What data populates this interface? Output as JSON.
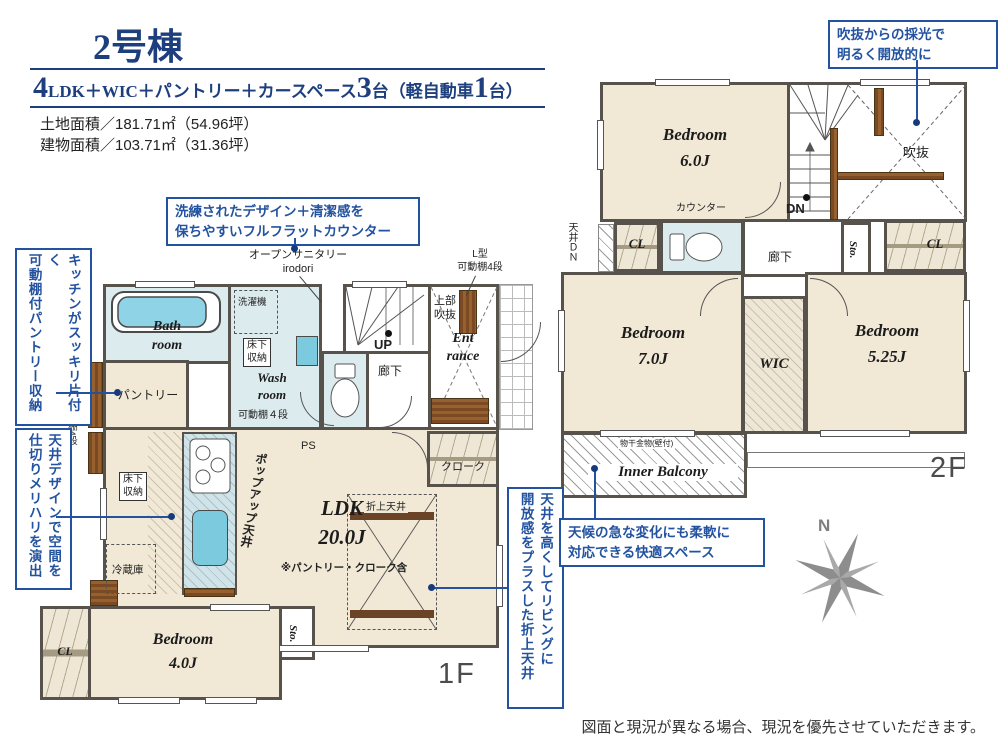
{
  "hdr": {
    "building": "2号棟",
    "spec": {
      "n1": "4",
      "t1": "LDK＋WIC＋パントリー＋カースペース",
      "n2": "3",
      "t2": "台（軽自動車",
      "n3": "1",
      "t3": "台）"
    },
    "land_area": "土地面積／181.71㎡（54.96坪）",
    "building_area": "建物面積／103.71㎡（31.36坪）"
  },
  "co": {
    "void_light": "吹抜からの採光で\n明るく開放的に",
    "flat_counter": "洗練されたデザイン＋清潔感を\n保ちやすいフルフラットカウンター",
    "pantry_storage": "キッチンがスッキリ片付く\n可動棚付パントリー収納",
    "ceiling_design": "天井デザインで空間を\n仕切りメリハリを演出",
    "oriage_ceiling": "天井を高くしてリビングに\n開放感をプラスした折上天井",
    "weather_space": "天候の急な変化にも柔軟に\n対応できる快適スペース"
  },
  "f1": {
    "label": "1F",
    "bath": "Bath\nroom",
    "washer": "洗濯機",
    "underfloor": "床下\n収納",
    "washroom": "Wash\nroom",
    "washroom_shelf": "可動棚４段",
    "pantry": "パントリー",
    "up": "UP",
    "hall": "廊下",
    "upper_void": "上部\n吹抜",
    "entrance": "Ent\nrance",
    "open_sanitary": "オープンサニタリー\nirodori",
    "l_shelf": "L型\n可動棚4段",
    "ps": "PS",
    "cloak": "クローク",
    "underfloor2": "床下\n収納",
    "fridge": "冷蔵庫",
    "popup": "ポップアップ天井",
    "ldk": "LDK\n20.0J",
    "ldk_note": "※パントリー・クローク含",
    "oriage": "折上天井",
    "bedroom4": "Bedroom\n4.0J",
    "cl": "CL",
    "sto": "Sto.",
    "counter": "カウンター",
    "shelf_left": "可動棚4段",
    "ceiling_dn": "天井DN"
  },
  "f2": {
    "label": "2F",
    "bedroom6": "Bedroom\n6.0J",
    "void": "吹抜",
    "dn": "DN",
    "counter": "カウンター",
    "cl_left": "CL",
    "ceiling_dn": "天井ＤＮ",
    "hall": "廊下",
    "sto": "Sto.",
    "cl_right": "CL",
    "bedroom7": "Bedroom\n7.0J",
    "wic": "WIC",
    "bedroom525": "Bedroom\n5.25J",
    "inner_balcony": "Inner Balcony",
    "hanger": "物干金物(壁付)"
  },
  "compass": {
    "north": "N"
  },
  "disclaimer": "図面と現況が異なる場合、現況を優先させていただきます。"
}
